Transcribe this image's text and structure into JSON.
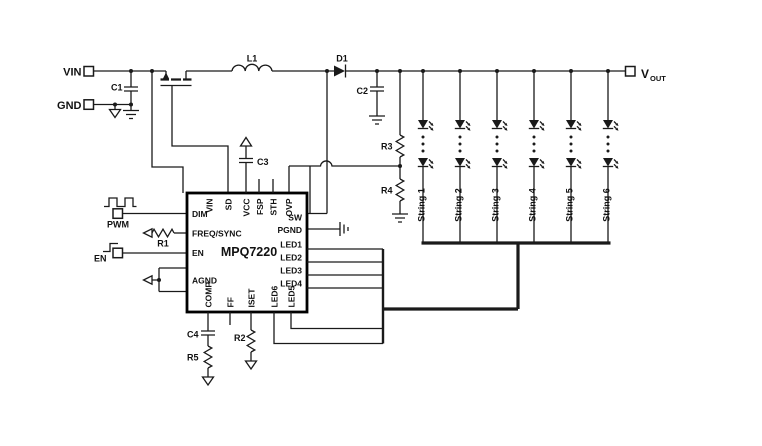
{
  "diagram": {
    "terminals": {
      "vin": "VIN",
      "gnd": "GND",
      "pwm": "PWM",
      "en": "EN",
      "vout": "V",
      "vout_sub": "OUT"
    },
    "ic": {
      "name": "MPQ7220",
      "top_pins": [
        "VIN",
        "SD",
        "VCC",
        "FSP",
        "STH",
        "OVP"
      ],
      "left_pins": [
        "DIM",
        "FREQ/SYNC",
        "EN",
        "AGND"
      ],
      "right_pins": [
        "SW",
        "PGND",
        "LED1",
        "LED2",
        "LED3",
        "LED4"
      ],
      "bottom_pins": [
        "COMP",
        "FF",
        "ISET",
        "LED6",
        "LED5"
      ]
    },
    "components": {
      "c1": "C1",
      "c2": "C2",
      "c3": "C3",
      "c4": "C4",
      "r1": "R1",
      "r2": "R2",
      "r3": "R3",
      "r4": "R4",
      "r5": "R5",
      "l1": "L1",
      "d1": "D1"
    },
    "strings": [
      "String 1",
      "String 2",
      "String 3",
      "String 4",
      "String 5",
      "String 6"
    ],
    "colors": {
      "line": "#1a1a1a",
      "background": "#ffffff"
    }
  }
}
